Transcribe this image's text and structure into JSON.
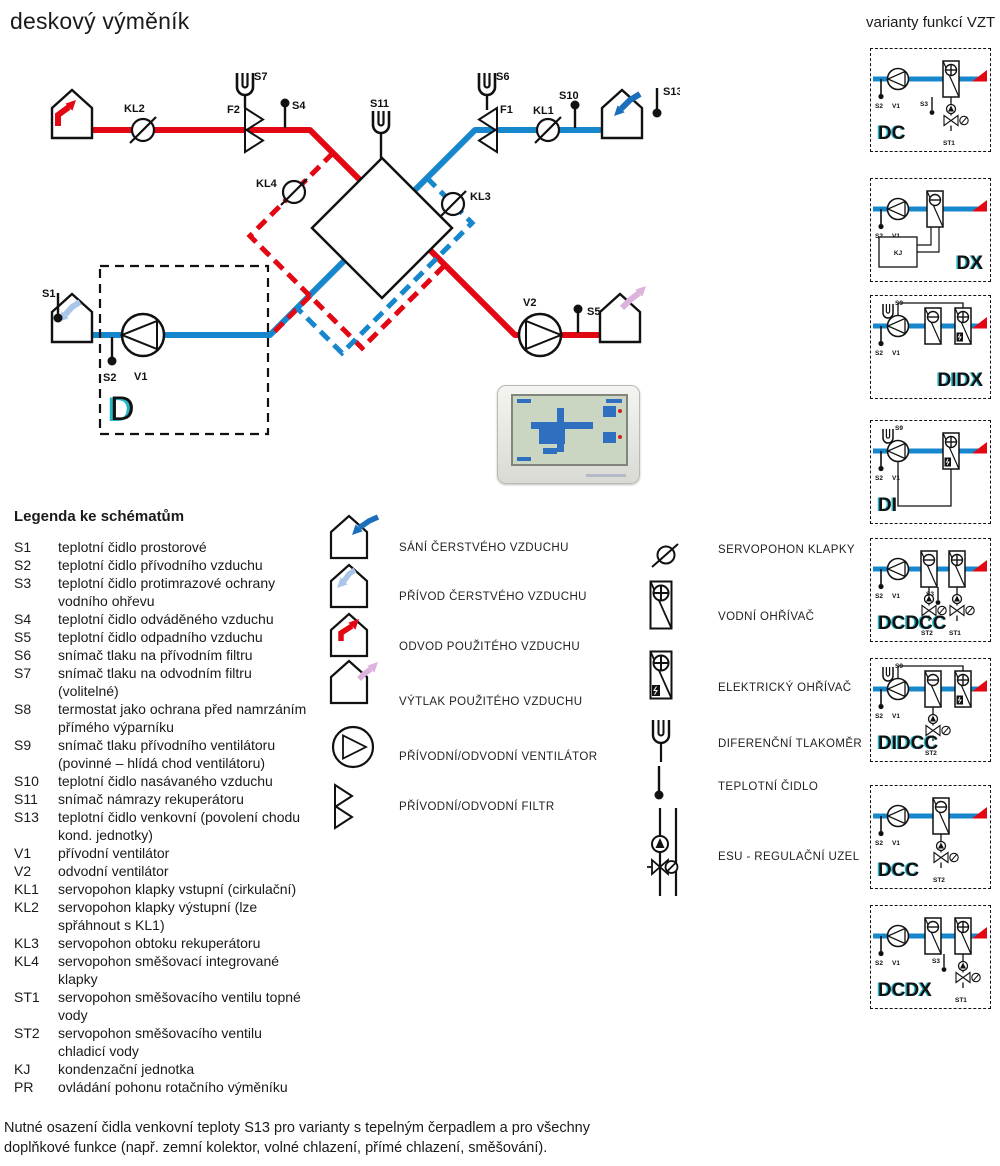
{
  "page": {
    "title": "deskový výměník"
  },
  "variants_header": "varianty funkcí VZT",
  "note": {
    "line1": "Nutné osazení čidla venkovní teploty S13 pro varianty s tepelným čerpadlem a pro všechny",
    "line2": "doplňkové funkce (např. zemní kolektor, volné chlazení, přímé chlazení, směšování)."
  },
  "schematic": {
    "labels": {
      "s1": "S1",
      "s2": "S2",
      "s4": "S4",
      "s5": "S5",
      "s6": "S6",
      "s7": "S7",
      "s10": "S10",
      "s11": "S11",
      "s13": "S13",
      "v1": "V1",
      "v2": "V2",
      "kl1": "KL1",
      "kl2": "KL2",
      "kl3": "KL3",
      "kl4": "KL4",
      "f1": "F1",
      "f2": "F2",
      "d": "D"
    }
  },
  "legend": {
    "title": "Legenda ke schématům",
    "items": [
      {
        "term": "S1",
        "def": "teplotní čidlo prostorové"
      },
      {
        "term": "S2",
        "def": "teplotní čidlo přívodního vzduchu"
      },
      {
        "term": "S3",
        "def": "teplotní čidlo protimrazové ochrany vodního ohřevu"
      },
      {
        "term": "S4",
        "def": "teplotní čidlo odváděného vzduchu"
      },
      {
        "term": "S5",
        "def": "teplotní čidlo odpadního vzduchu"
      },
      {
        "term": "S6",
        "def": "snímač tlaku na přívodním filtru"
      },
      {
        "term": "S7",
        "def": "snímač tlaku na odvodním filtru (volitelné)"
      },
      {
        "term": "S8",
        "def": "termostat jako ochrana před namrzáním přímého výparníku"
      },
      {
        "term": "S9",
        "def": "snímač tlaku přívodního ventilátoru (povinné – hlídá chod ventilátoru)"
      },
      {
        "term": "S10",
        "def": "teplotní čidlo nasávaného vzduchu"
      },
      {
        "term": "S11",
        "def": "snímač námrazy rekuperátoru"
      },
      {
        "term": "S13",
        "def": "teplotní čidlo venkovní (povolení chodu kond. jednotky)"
      },
      {
        "term": "V1",
        "def": "přívodní ventilátor"
      },
      {
        "term": "V2",
        "def": "odvodní ventilátor"
      },
      {
        "term": "KL1",
        "def": "servopohon klapky vstupní (cirkulační)"
      },
      {
        "term": "KL2",
        "def": "servopohon klapky výstupní (lze spřáhnout s KL1)"
      },
      {
        "term": "KL3",
        "def": "servopohon obtoku rekuperátoru"
      },
      {
        "term": "KL4",
        "def": "servopohon směšovací integrované klapky"
      },
      {
        "term": "ST1",
        "def": "servopohon směšovacího ventilu topné vody"
      },
      {
        "term": "ST2",
        "def": "servopohon směšovacího ventilu chladicí vody"
      },
      {
        "term": "KJ",
        "def": "kondenzační jednotka"
      },
      {
        "term": "PR",
        "def": "ovládání pohonu rotačního výměníku"
      }
    ]
  },
  "symbols_left": {
    "items": [
      {
        "name": "house-fresh-air-intake",
        "label": "SÁNÍ ČERSTVÉHO VZDUCHU"
      },
      {
        "name": "house-fresh-air-supply",
        "label": "PŘÍVOD ČERSTVÉHO VZDUCHU"
      },
      {
        "name": "house-used-air-extract",
        "label": "ODVOD POUŽITÉHO VZDUCHU"
      },
      {
        "name": "house-used-air-discharge",
        "label": "VÝTLAK POUŽITÉHO VZDUCHU"
      },
      {
        "name": "fan",
        "label": "PŘÍVODNÍ/ODVODNÍ VENTILÁTOR"
      },
      {
        "name": "filter",
        "label": "PŘÍVODNÍ/ODVODNÍ FILTR"
      }
    ]
  },
  "symbols_right": {
    "items": [
      {
        "name": "damper-actuator",
        "label": "SERVOPOHON KLAPKY"
      },
      {
        "name": "water-heater",
        "label": "VODNÍ OHŘÍVAČ"
      },
      {
        "name": "electric-heater",
        "label": "ELEKTRICKÝ OHŘÍVAČ"
      },
      {
        "name": "differential-manometer",
        "label": "DIFERENČNÍ TLAKOMĚR"
      },
      {
        "name": "temperature-sensor",
        "label": "TEPLOTNÍ ČIDLO"
      },
      {
        "name": "esu-control-node",
        "label": "ESU - REGULAČNÍ UZEL"
      }
    ]
  },
  "variants": {
    "mini_labels": {
      "s2": "S2",
      "v1": "V1",
      "s3": "S3",
      "s9": "S9",
      "kj": "KJ"
    },
    "items": [
      {
        "name": "DC",
        "s9": false,
        "loop": null,
        "kj": false,
        "label_corner": "bl",
        "units": [
          {
            "kind": "heater_w",
            "x": 72,
            "esu": "ST1",
            "s3": true
          }
        ]
      },
      {
        "name": "DX",
        "s9": false,
        "loop": null,
        "kj": true,
        "label_corner": "br",
        "units": [
          {
            "kind": "cooler",
            "x": 56
          }
        ]
      },
      {
        "name": "DIDX",
        "s9": true,
        "loop": "top",
        "kj": false,
        "label_corner": "br",
        "units": [
          {
            "kind": "cooler",
            "x": 54
          },
          {
            "kind": "heater_e",
            "x": 84
          }
        ]
      },
      {
        "name": "DI",
        "s9": true,
        "loop": "bottom",
        "kj": false,
        "label_corner": "bl",
        "units": [
          {
            "kind": "heater_e",
            "x": 72
          }
        ]
      },
      {
        "name": "DCDCC",
        "s9": false,
        "loop": null,
        "kj": false,
        "label_corner": "bl",
        "units": [
          {
            "kind": "cooler",
            "x": 50,
            "esu": "ST2"
          },
          {
            "kind": "heater_w",
            "x": 78,
            "esu": "ST1",
            "s3": true
          }
        ]
      },
      {
        "name": "DIDCC",
        "s9": true,
        "loop": "top",
        "kj": false,
        "label_corner": "bl",
        "units": [
          {
            "kind": "cooler",
            "x": 54,
            "esu": "ST2"
          },
          {
            "kind": "heater_e",
            "x": 84
          }
        ]
      },
      {
        "name": "DCC",
        "s9": false,
        "loop": null,
        "kj": false,
        "label_corner": "bl",
        "units": [
          {
            "kind": "cooler",
            "x": 62,
            "esu": "ST2"
          }
        ]
      },
      {
        "name": "DCDX",
        "s9": false,
        "loop": null,
        "kj": false,
        "label_corner": "bl",
        "units": [
          {
            "kind": "cooler",
            "x": 54
          },
          {
            "kind": "heater_w",
            "x": 84,
            "esu": "ST1",
            "s3": true
          }
        ]
      }
    ]
  },
  "colors": {
    "red": "#e30613",
    "blue": "#1787cd",
    "light_blue": "#a9c6e9",
    "dark_blue": "#1a6fbd",
    "pink": "#dcb3dc",
    "cyan": "#25b6c9",
    "ink": "#111111"
  }
}
